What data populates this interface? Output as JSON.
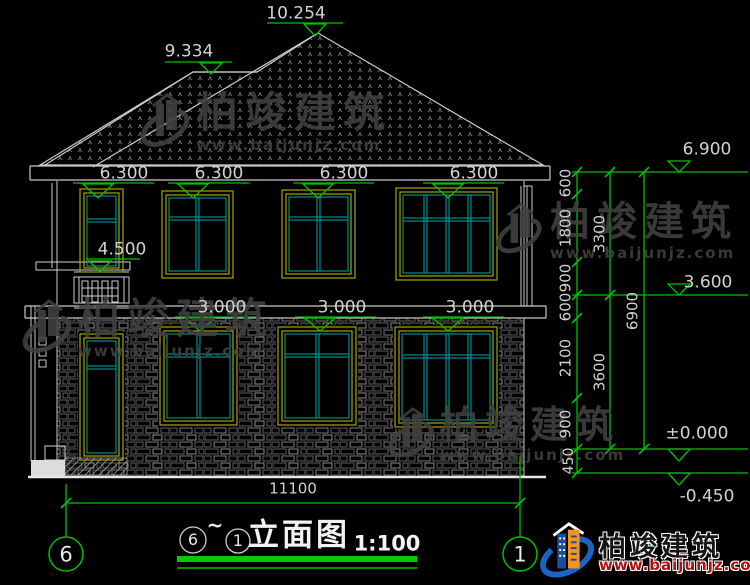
{
  "drawing": {
    "title": {
      "axis_from": "6",
      "tilde": "~",
      "axis_to": "1",
      "name": "立面图",
      "scale": "1:100"
    },
    "axis_bubbles": {
      "left": "6",
      "right": "1"
    },
    "levels": {
      "ridge": "10.254",
      "lower_ridge": "9.334",
      "eave": "6.900",
      "floor2_window_tops": [
        "6.300",
        "6.300",
        "6.300",
        "6.300"
      ],
      "balcony": "4.500",
      "floor1_window_tops": [
        "3.000",
        "3.000",
        "3.000"
      ],
      "upper_right": "3.600",
      "zero": "±0.000",
      "below_grade": "-0.450"
    },
    "dimensions": {
      "chain_inner": [
        "600",
        "1800",
        "900",
        "600",
        "2100",
        "900"
      ],
      "plinth": "450",
      "chain_middle": [
        "3300",
        "3600"
      ],
      "chain_outer": "6900",
      "overall_width": "11100"
    }
  },
  "watermark": {
    "brand": "柏竣建筑",
    "url": "www.baijunjz.com"
  },
  "footer": {
    "brand": "柏竣建筑",
    "url": "www.baijunjz.com"
  },
  "colors": {
    "line_green": "#00bf00",
    "line_white": "#c9c9c9",
    "frame_yellow": "#a8a400",
    "frame_cyan": "#00a6a6",
    "brand_blue": "#1b63c4",
    "brand_orange": "#f7941d"
  }
}
